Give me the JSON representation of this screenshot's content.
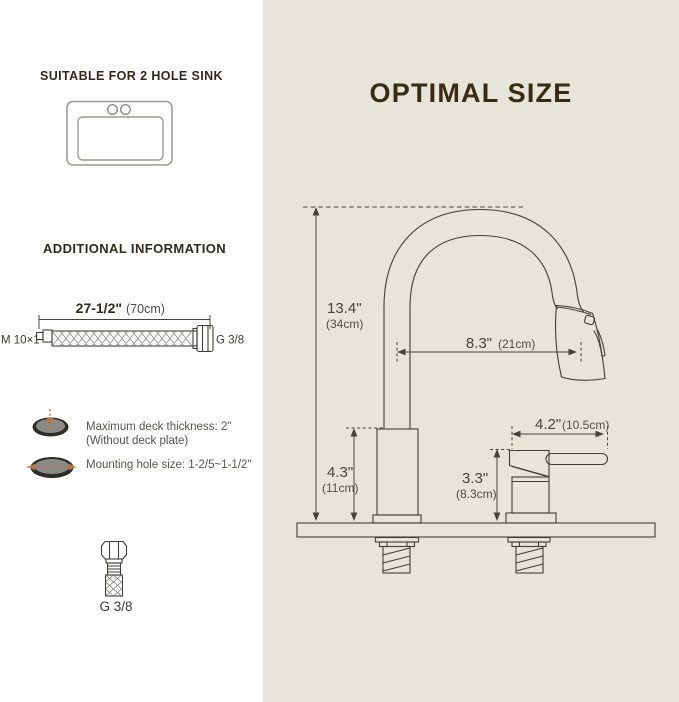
{
  "title": "OPTIMAL SIZE",
  "left": {
    "suitable_heading": "SUITABLE FOR 2 HOLE SINK",
    "additional_heading": "ADDITIONAL INFORMATION",
    "hose": {
      "length_in": "27-1/2\"",
      "length_cm": "(70cm)",
      "left_thread": "M 10×1",
      "right_thread": "G 3/8"
    },
    "deck_note_line1": "Maximum deck thickness: 2\"",
    "deck_note_line2": "(Without deck plate)",
    "hole_note": "Mounting hole size: 1-2/5~1-1/2\"",
    "connector_label": "G 3/8"
  },
  "diagram": {
    "spout_height_in": "13.4\"",
    "spout_height_cm": "(34cm)",
    "spout_reach_in": "8.3\"",
    "spout_reach_cm": "(21cm)",
    "handle_reach_in": "4.2\"",
    "handle_reach_cm": "(10.5cm)",
    "body_height_in": "4.3\"",
    "body_height_cm": "(11cm)",
    "handle_height_in": "3.3\"",
    "handle_height_cm": "(8.3cm)"
  },
  "colors": {
    "panel_bg": "#e7e4da",
    "line_ink": "#403f37",
    "title_brown": "#3a2c12",
    "accent_orange": "#bd7240"
  }
}
